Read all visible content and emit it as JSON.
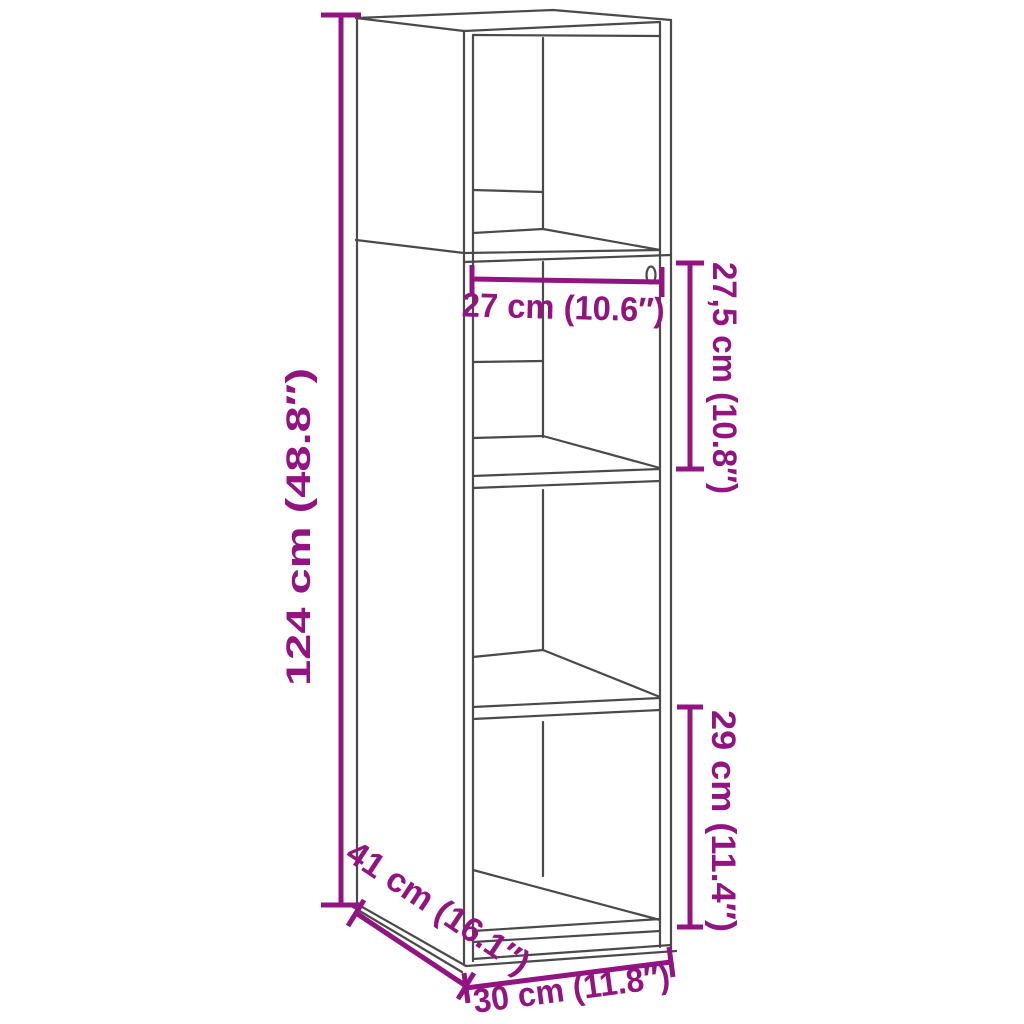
{
  "diagram": {
    "type": "furniture-dimension-drawing",
    "subject": "tall narrow highboard cabinet with 4 open compartments, three-quarter wireframe view, open front",
    "background": "#ffffff"
  },
  "colors": {
    "dimension_accent": "#911480",
    "drawing_line": "#4a4a4a",
    "background": "#ffffff"
  },
  "dims": {
    "overall_height": {
      "label": "124 cm (48.8″)",
      "placement": "vertical line, left of cabinet"
    },
    "inner_width": {
      "label": "27 cm (10.6″)",
      "placement": "horizontal line, below top compartment"
    },
    "upper_compartment_height": {
      "label": "27,5 cm (10.8″)",
      "placement": "vertical line, upper right side"
    },
    "lower_compartment_height": {
      "label": "29 cm (11.4″)",
      "placement": "vertical line, lower right side"
    },
    "depth": {
      "label": "41 cm (16.1″)",
      "placement": "diagonal line, bottom left"
    },
    "overall_width": {
      "label": "30 cm (11.8″)",
      "placement": "horizontal line, bottom front"
    }
  }
}
